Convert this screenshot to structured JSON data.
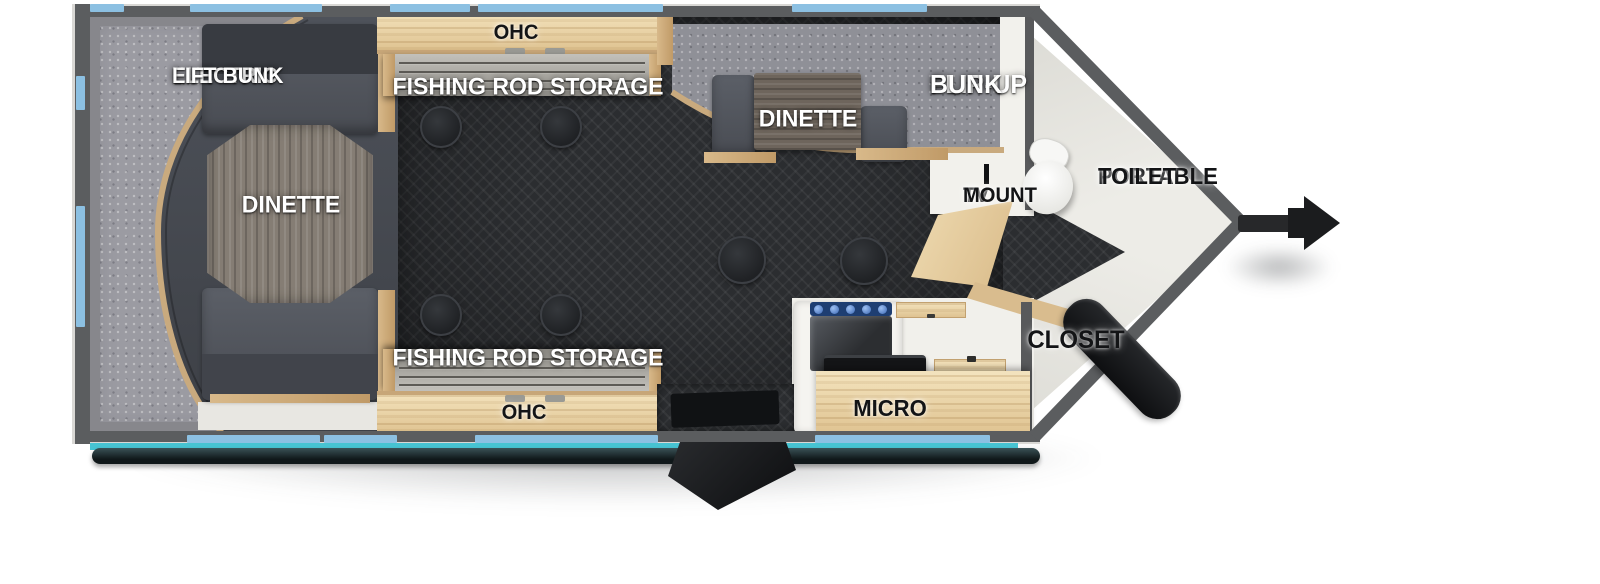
{
  "floorplan": {
    "type": "travel-trailer-top-view-floorplan",
    "labels": {
      "electric_lift_bunk": {
        "line1": "ELECTRIC",
        "line2": "LIFT BUNK"
      },
      "dinette_left": {
        "text": "DINETTE"
      },
      "ohc_top": {
        "text": "OHC"
      },
      "fishing_rod_top": {
        "text": "FISHING ROD STORAGE"
      },
      "flip_up_bunk": {
        "line1": "FLIP-UP",
        "line2": "BUNK"
      },
      "dinette_right": {
        "text": "DINETTE"
      },
      "tv_mount": {
        "line1": "TV",
        "line2": "MOUNT"
      },
      "portable_toilet": {
        "line1": "PORTABLE",
        "line2": "TOILET"
      },
      "closet": {
        "text": "CLOSET"
      },
      "micro": {
        "text": "MICRO"
      },
      "fishing_rod_bottom": {
        "text": "FISHING ROD STORAGE"
      },
      "ohc_bottom": {
        "text": "OHC"
      }
    },
    "colors": {
      "wall_gray": "#5b5d5f",
      "window_blue": "#8cc0e2",
      "awning_teal": "#47c3d2",
      "floor_dark": "#2b2d30",
      "wood_light": "#e9d2a6",
      "wood_trim": "#c9a97b",
      "bunk_gray": "#9b9ba2",
      "bench_gray": "#53565e",
      "label_white": "#ffffff",
      "label_black": "#131416"
    }
  }
}
